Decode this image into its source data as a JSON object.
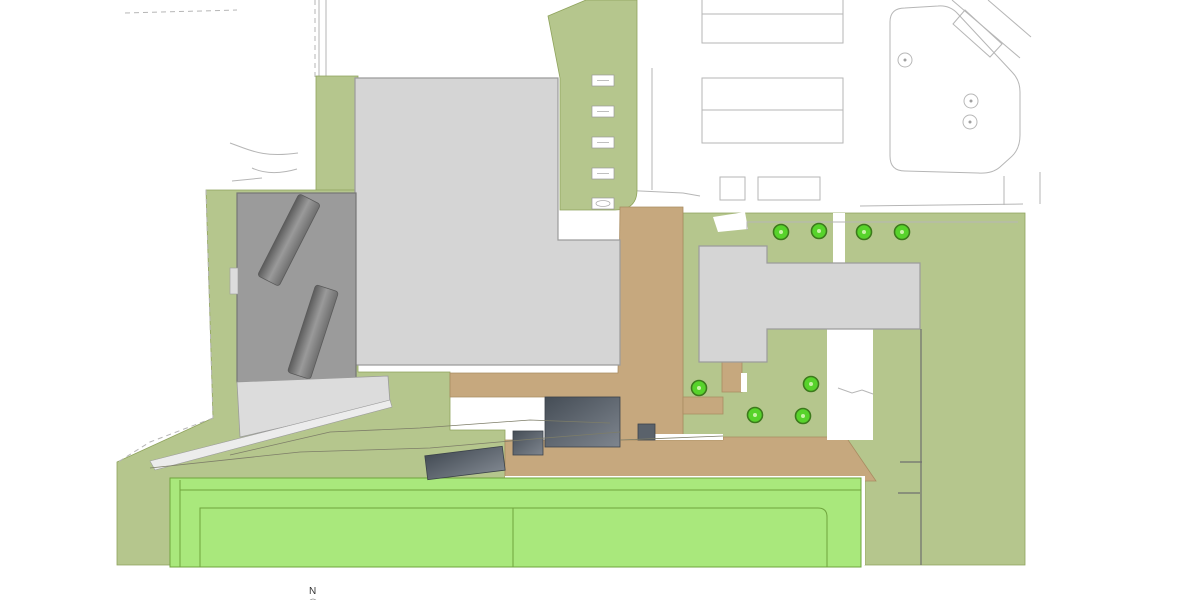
{
  "site": {
    "north_label": "N",
    "trees": [
      {
        "x": 781,
        "y": 232
      },
      {
        "x": 819,
        "y": 231
      },
      {
        "x": 864,
        "y": 232
      },
      {
        "x": 902,
        "y": 232
      },
      {
        "x": 699,
        "y": 388
      },
      {
        "x": 811,
        "y": 384
      },
      {
        "x": 755,
        "y": 415
      },
      {
        "x": 803,
        "y": 416
      }
    ],
    "tree_radius": 7.5,
    "survey_circles": [
      {
        "x": 905,
        "y": 60
      },
      {
        "x": 971,
        "y": 101
      },
      {
        "x": 970,
        "y": 122
      }
    ],
    "survey_circle_radius": 7,
    "bench_markers": [
      {
        "x": 592,
        "y": 75,
        "w": 22,
        "h": 11,
        "oval": false
      },
      {
        "x": 592,
        "y": 106,
        "w": 22,
        "h": 11,
        "oval": false
      },
      {
        "x": 592,
        "y": 137,
        "w": 22,
        "h": 11,
        "oval": false
      },
      {
        "x": 592,
        "y": 168,
        "w": 22,
        "h": 11,
        "oval": false
      },
      {
        "x": 592,
        "y": 198,
        "w": 22,
        "h": 11,
        "oval": true
      }
    ]
  },
  "colors": {
    "olive": "#b5c68d",
    "olive_edge": "#8fa35c",
    "field": "#a9e87c",
    "field_edge": "#6fa43d",
    "tan": "#c6a87e",
    "tan_edge": "#a98c62",
    "bldg_light": "#d5d5d5",
    "bldg_edge": "#9c9c9c",
    "bldg_med": "#9b9b9b",
    "bldg_med_edge": "#767676",
    "bldg_dark_a": "#454d56",
    "bldg_dark_b": "#7e858e",
    "tree": "#57d32b",
    "tree_edge": "#3c7a1c",
    "tree_dot": "#c8f2a6",
    "line": "#b6b6b6",
    "line_dark": "#6f6f6f",
    "apron": "#dcdcdc",
    "white": "#ffffff",
    "north_text": "#333333"
  }
}
